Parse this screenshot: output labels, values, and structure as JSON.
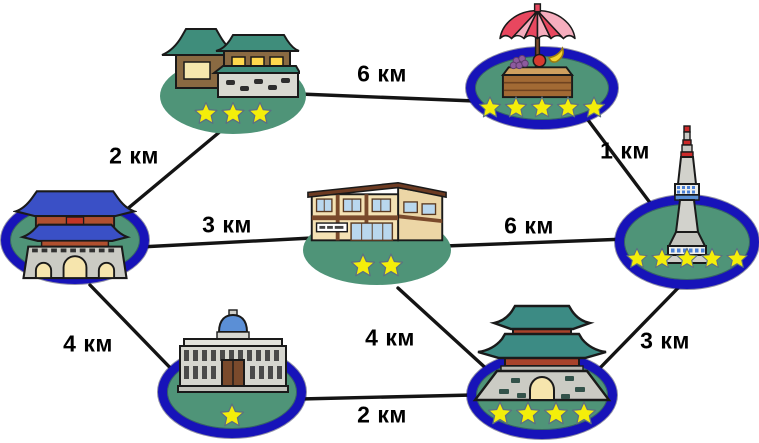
{
  "diagram": {
    "background": "#ffffff",
    "colors": {
      "node_fill": "#4f9478",
      "ring": "#1713b9",
      "star": "#f4ee0a",
      "edge": "#141414",
      "label_text": "#000000"
    },
    "nodes": [
      {
        "id": "hanok-house",
        "icon": "hanok-house-icon",
        "rating": 3,
        "ring": false,
        "cx": 233,
        "cy": 96,
        "w": 146,
        "h": 76,
        "icon_x": 160,
        "icon_y": 22,
        "icon_w": 140,
        "icon_h": 82,
        "stars_y": 113,
        "star_size": 24
      },
      {
        "id": "fruit-stand",
        "icon": "fruit-stand-icon",
        "rating": 5,
        "ring": true,
        "cx": 542,
        "cy": 88,
        "w": 152,
        "h": 82,
        "icon_x": 489,
        "icon_y": 2,
        "icon_w": 97,
        "icon_h": 98,
        "stars_y": 107,
        "star_size": 23
      },
      {
        "id": "palace-gate",
        "icon": "palace-gate-icon",
        "rating": 0,
        "ring": true,
        "cx": 75,
        "cy": 240,
        "w": 148,
        "h": 88,
        "icon_x": 13,
        "icon_y": 178,
        "icon_w": 124,
        "icon_h": 102,
        "stars_y": 0,
        "star_size": 24
      },
      {
        "id": "shop-building",
        "icon": "shop-building-icon",
        "rating": 2,
        "ring": false,
        "cx": 377,
        "cy": 250,
        "w": 148,
        "h": 70,
        "icon_x": 306,
        "icon_y": 178,
        "icon_w": 142,
        "icon_h": 70,
        "stars_y": 265,
        "star_size": 25
      },
      {
        "id": "namsan-tower",
        "icon": "namsan-tower-icon",
        "rating": 5,
        "ring": true,
        "cx": 687,
        "cy": 242,
        "w": 144,
        "h": 94,
        "icon_x": 659,
        "icon_y": 118,
        "icon_w": 56,
        "icon_h": 148,
        "stars_y": 258,
        "star_size": 22
      },
      {
        "id": "stone-palace",
        "icon": "stone-palace-icon",
        "rating": 1,
        "ring": true,
        "cx": 232,
        "cy": 392,
        "w": 148,
        "h": 92,
        "icon_x": 170,
        "icon_y": 308,
        "icon_w": 126,
        "icon_h": 86,
        "stars_y": 415,
        "star_size": 25
      },
      {
        "id": "temple-gate",
        "icon": "temple-gate-icon",
        "rating": 4,
        "ring": true,
        "cx": 542,
        "cy": 395,
        "w": 150,
        "h": 88,
        "icon_x": 467,
        "icon_y": 302,
        "icon_w": 150,
        "icon_h": 100,
        "stars_y": 413,
        "star_size": 25
      }
    ],
    "edges": [
      {
        "from": "hanok-house",
        "to": "fruit-stand",
        "label": "6 км",
        "x1": 300,
        "y1": 94,
        "x2": 475,
        "y2": 101,
        "lx": 382,
        "ly": 74
      },
      {
        "from": "hanok-house",
        "to": "palace-gate",
        "label": "2 км",
        "x1": 222,
        "y1": 130,
        "x2": 120,
        "y2": 215,
        "lx": 134,
        "ly": 156
      },
      {
        "from": "fruit-stand",
        "to": "namsan-tower",
        "label": "1 км",
        "x1": 588,
        "y1": 120,
        "x2": 657,
        "y2": 212,
        "lx": 625,
        "ly": 151
      },
      {
        "from": "palace-gate",
        "to": "shop-building",
        "label": "3 км",
        "x1": 140,
        "y1": 247,
        "x2": 312,
        "y2": 238,
        "lx": 227,
        "ly": 225
      },
      {
        "from": "shop-building",
        "to": "namsan-tower",
        "label": "6 км",
        "x1": 445,
        "y1": 246,
        "x2": 627,
        "y2": 239,
        "lx": 529,
        "ly": 226
      },
      {
        "from": "palace-gate",
        "to": "stone-palace",
        "label": "4 км",
        "x1": 90,
        "y1": 285,
        "x2": 182,
        "y2": 380,
        "lx": 88,
        "ly": 344
      },
      {
        "from": "shop-building",
        "to": "temple-gate",
        "label": "4 км",
        "x1": 398,
        "y1": 288,
        "x2": 490,
        "y2": 372,
        "lx": 390,
        "ly": 338
      },
      {
        "from": "stone-palace",
        "to": "temple-gate",
        "label": "2 км",
        "x1": 300,
        "y1": 399,
        "x2": 473,
        "y2": 395,
        "lx": 382,
        "ly": 415
      },
      {
        "from": "namsan-tower",
        "to": "temple-gate",
        "label": "3 км",
        "x1": 679,
        "y1": 287,
        "x2": 599,
        "y2": 369,
        "lx": 665,
        "ly": 341
      }
    ]
  }
}
